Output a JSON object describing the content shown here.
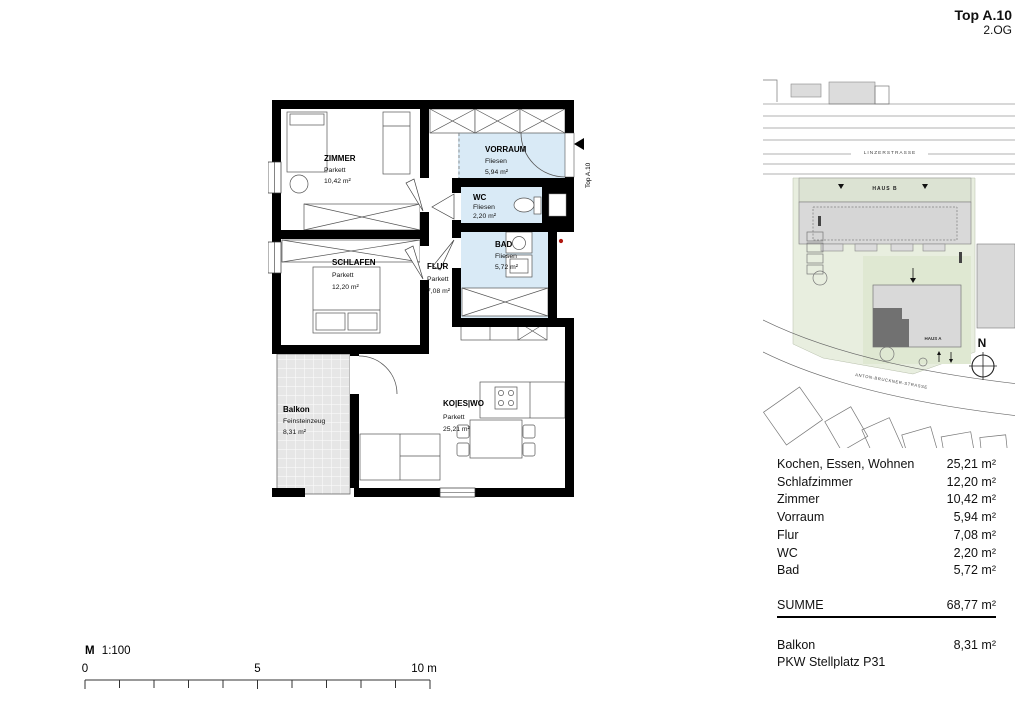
{
  "header": {
    "title": "Top A.10",
    "floor": "2.OG"
  },
  "plan": {
    "entrance_label": "Top A.10",
    "rooms": {
      "zimmer": {
        "name": "ZIMMER",
        "floor": "Parkett",
        "area": "10,42 m²"
      },
      "schlafen": {
        "name": "SCHLAFEN",
        "floor": "Parkett",
        "area": "12,20 m²"
      },
      "vorraum": {
        "name": "VORRAUM",
        "floor": "Fliesen",
        "area": "5,94 m²"
      },
      "wc": {
        "name": "WC",
        "floor": "Fliesen",
        "area": "2,20 m²"
      },
      "bad": {
        "name": "BAD",
        "floor": "Fliesen",
        "area": "5,72 m²"
      },
      "flur": {
        "name": "FLUR",
        "floor": "Parkett",
        "area": "7,08 m²"
      },
      "koeswo": {
        "name": "KO|ES|WO",
        "floor": "Parkett",
        "area": "25,21 m²"
      },
      "balkon": {
        "name": "Balkon",
        "floor": "Feinsteinzeug",
        "area": "8,31 m²"
      }
    }
  },
  "scalebar": {
    "label_bold": "M",
    "label_rest": "1:100",
    "tick0": "0",
    "tick5": "5",
    "tick10": "10 m"
  },
  "siteplan": {
    "street_top": "LINZERSTRASSE",
    "street_bottom": "ANTON-BRUCKNER-STRASSE",
    "haus_a": "HAUS A",
    "haus_b": "HAUS B",
    "north": "N"
  },
  "area_table": {
    "rows": [
      {
        "label": "Kochen, Essen, Wohnen",
        "value": "25,21 m²"
      },
      {
        "label": "Schlafzimmer",
        "value": "12,20 m²"
      },
      {
        "label": "Zimmer",
        "value": "10,42 m²"
      },
      {
        "label": "Vorraum",
        "value": "5,94 m²"
      },
      {
        "label": "Flur",
        "value": "7,08 m²"
      },
      {
        "label": "WC",
        "value": "2,20 m²"
      },
      {
        "label": "Bad",
        "value": "5,72 m²"
      }
    ],
    "summe": {
      "label": "SUMME",
      "value": "68,77 m²"
    },
    "balkon": {
      "label": "Balkon",
      "value": "8,31 m²"
    },
    "stellplatz": {
      "label": "PKW Stellplatz P31"
    }
  },
  "colors": {
    "wall": "#000000",
    "wet_room": "#d9eaf6",
    "balcony_tile": "#e6e6e6",
    "site_green": "#e8eedf",
    "building_gray": "#d9d9d9",
    "unit_highlight": "#717171",
    "marker_red": "#b01810"
  }
}
